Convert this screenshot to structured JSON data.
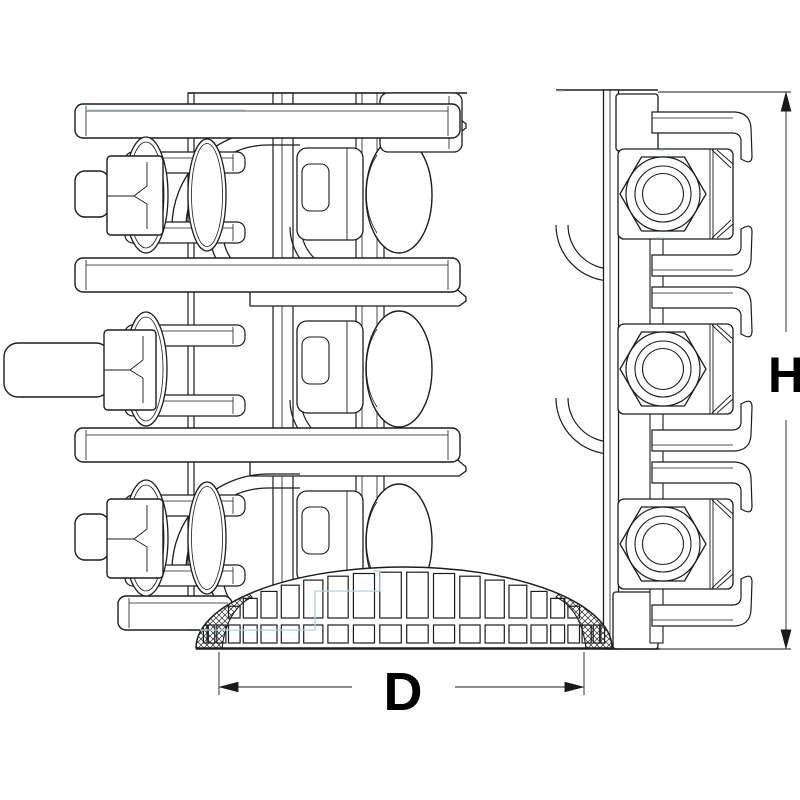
{
  "page": {
    "background": "#ffffff"
  },
  "drawing": {
    "type": "technical-line-drawing",
    "subject": "pipe repair clamp coupling with bolted lugs, hex nuts and meshed gasket dome, side view",
    "labels": {
      "diameter": "D",
      "height": "H"
    },
    "colors": {
      "outline": "#1c1c1c",
      "thin": "#3d3d3d",
      "hidden_line": "#a7d6e8",
      "dimension": "#1a1a1a",
      "text": "#000000",
      "background": "#ffffff"
    }
  }
}
